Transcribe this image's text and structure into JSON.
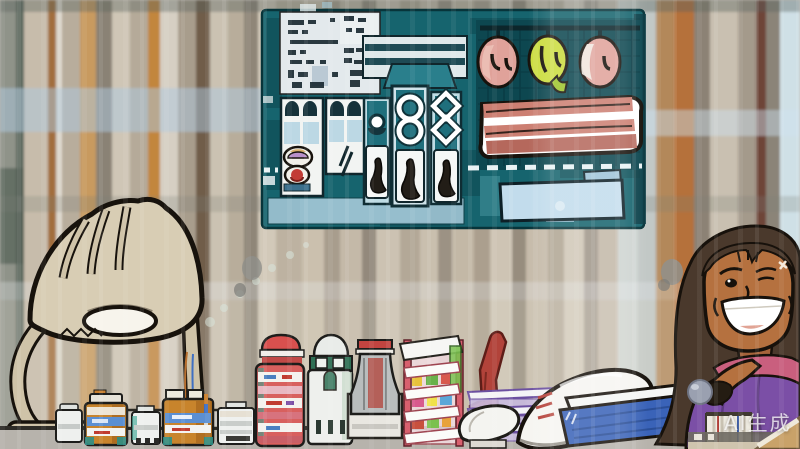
{
  "watermark": {
    "label": "AI生成"
  },
  "palette": {
    "board_teal": "#16646e",
    "board_dark": "#0d4750",
    "board_light": "#bcd8e4",
    "card_white": "#e3e9ec",
    "sign_blue": "#c2dcec",
    "fruit_pink": "#e0a29a",
    "fruit_green": "#cbdc3e",
    "bacon_pink": "#cc7f72",
    "lamp_beige": "#cfc3a8",
    "counter_gray": "#b7b3ac",
    "bottle_amber": "#c8842c",
    "label_blue": "#5b8fd2",
    "jar_red": "#d8605e",
    "bottle_green": "#2e6f54",
    "rack_pink": "#d8606e",
    "stand_red": "#b2433a",
    "shoe_white": "#f6f5f1",
    "swoosh_red": "#a93a34",
    "book_blue": "#3a63b8",
    "shelf_purple": "#cabce0",
    "skin": "#b5713f",
    "hair": "#4a392c",
    "shirt_purple": "#7b4fa6",
    "collar_pink": "#c95f7e",
    "ball_gray": "#9aa0b0"
  },
  "scene": {
    "setting": "illustrated shop counter",
    "board_sections": [
      "menu-card",
      "display-cases",
      "vending-columns",
      "produce-fruits",
      "bacon-shelf",
      "blank-sign"
    ],
    "objects": [
      "desk-lamp",
      "pill-bottles",
      "striped-jar",
      "cream-bottle",
      "vase-bottle",
      "display-rack",
      "red-stand",
      "shelf-trays",
      "white-sneaker",
      "blue-book",
      "book-spines",
      "counter"
    ],
    "character": {
      "type": "smiling-woman",
      "hair": "dark-brown",
      "top": "purple",
      "holding": "gray-ball"
    }
  }
}
